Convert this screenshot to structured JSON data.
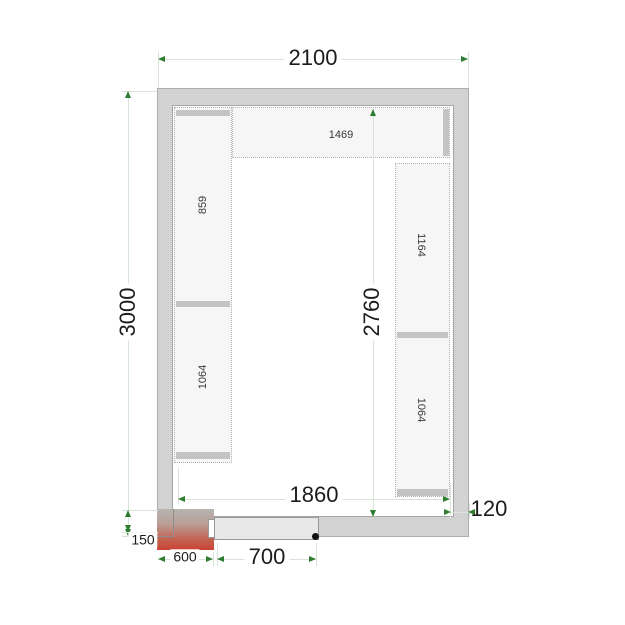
{
  "dims": {
    "outer_width": "2100",
    "outer_height": "3000",
    "inner_height": "2760",
    "inner_width": "1860",
    "wall_thickness": "120",
    "door_width": "700",
    "door_frame_width": "600",
    "door_frame_depth": "150"
  },
  "shelves": {
    "top": "1469",
    "left_upper": "859",
    "left_lower": "1064",
    "right_upper": "1164",
    "right_lower": "1064"
  },
  "colors": {
    "wall": "#d2d2d2",
    "shelf": "#f6f6f6",
    "dimension_line": "#d8e4d8",
    "arrow_green": "#2f7d33",
    "heater_red": "#ca4335",
    "door": "#e8e8e8",
    "text": "#1c1c1c"
  }
}
